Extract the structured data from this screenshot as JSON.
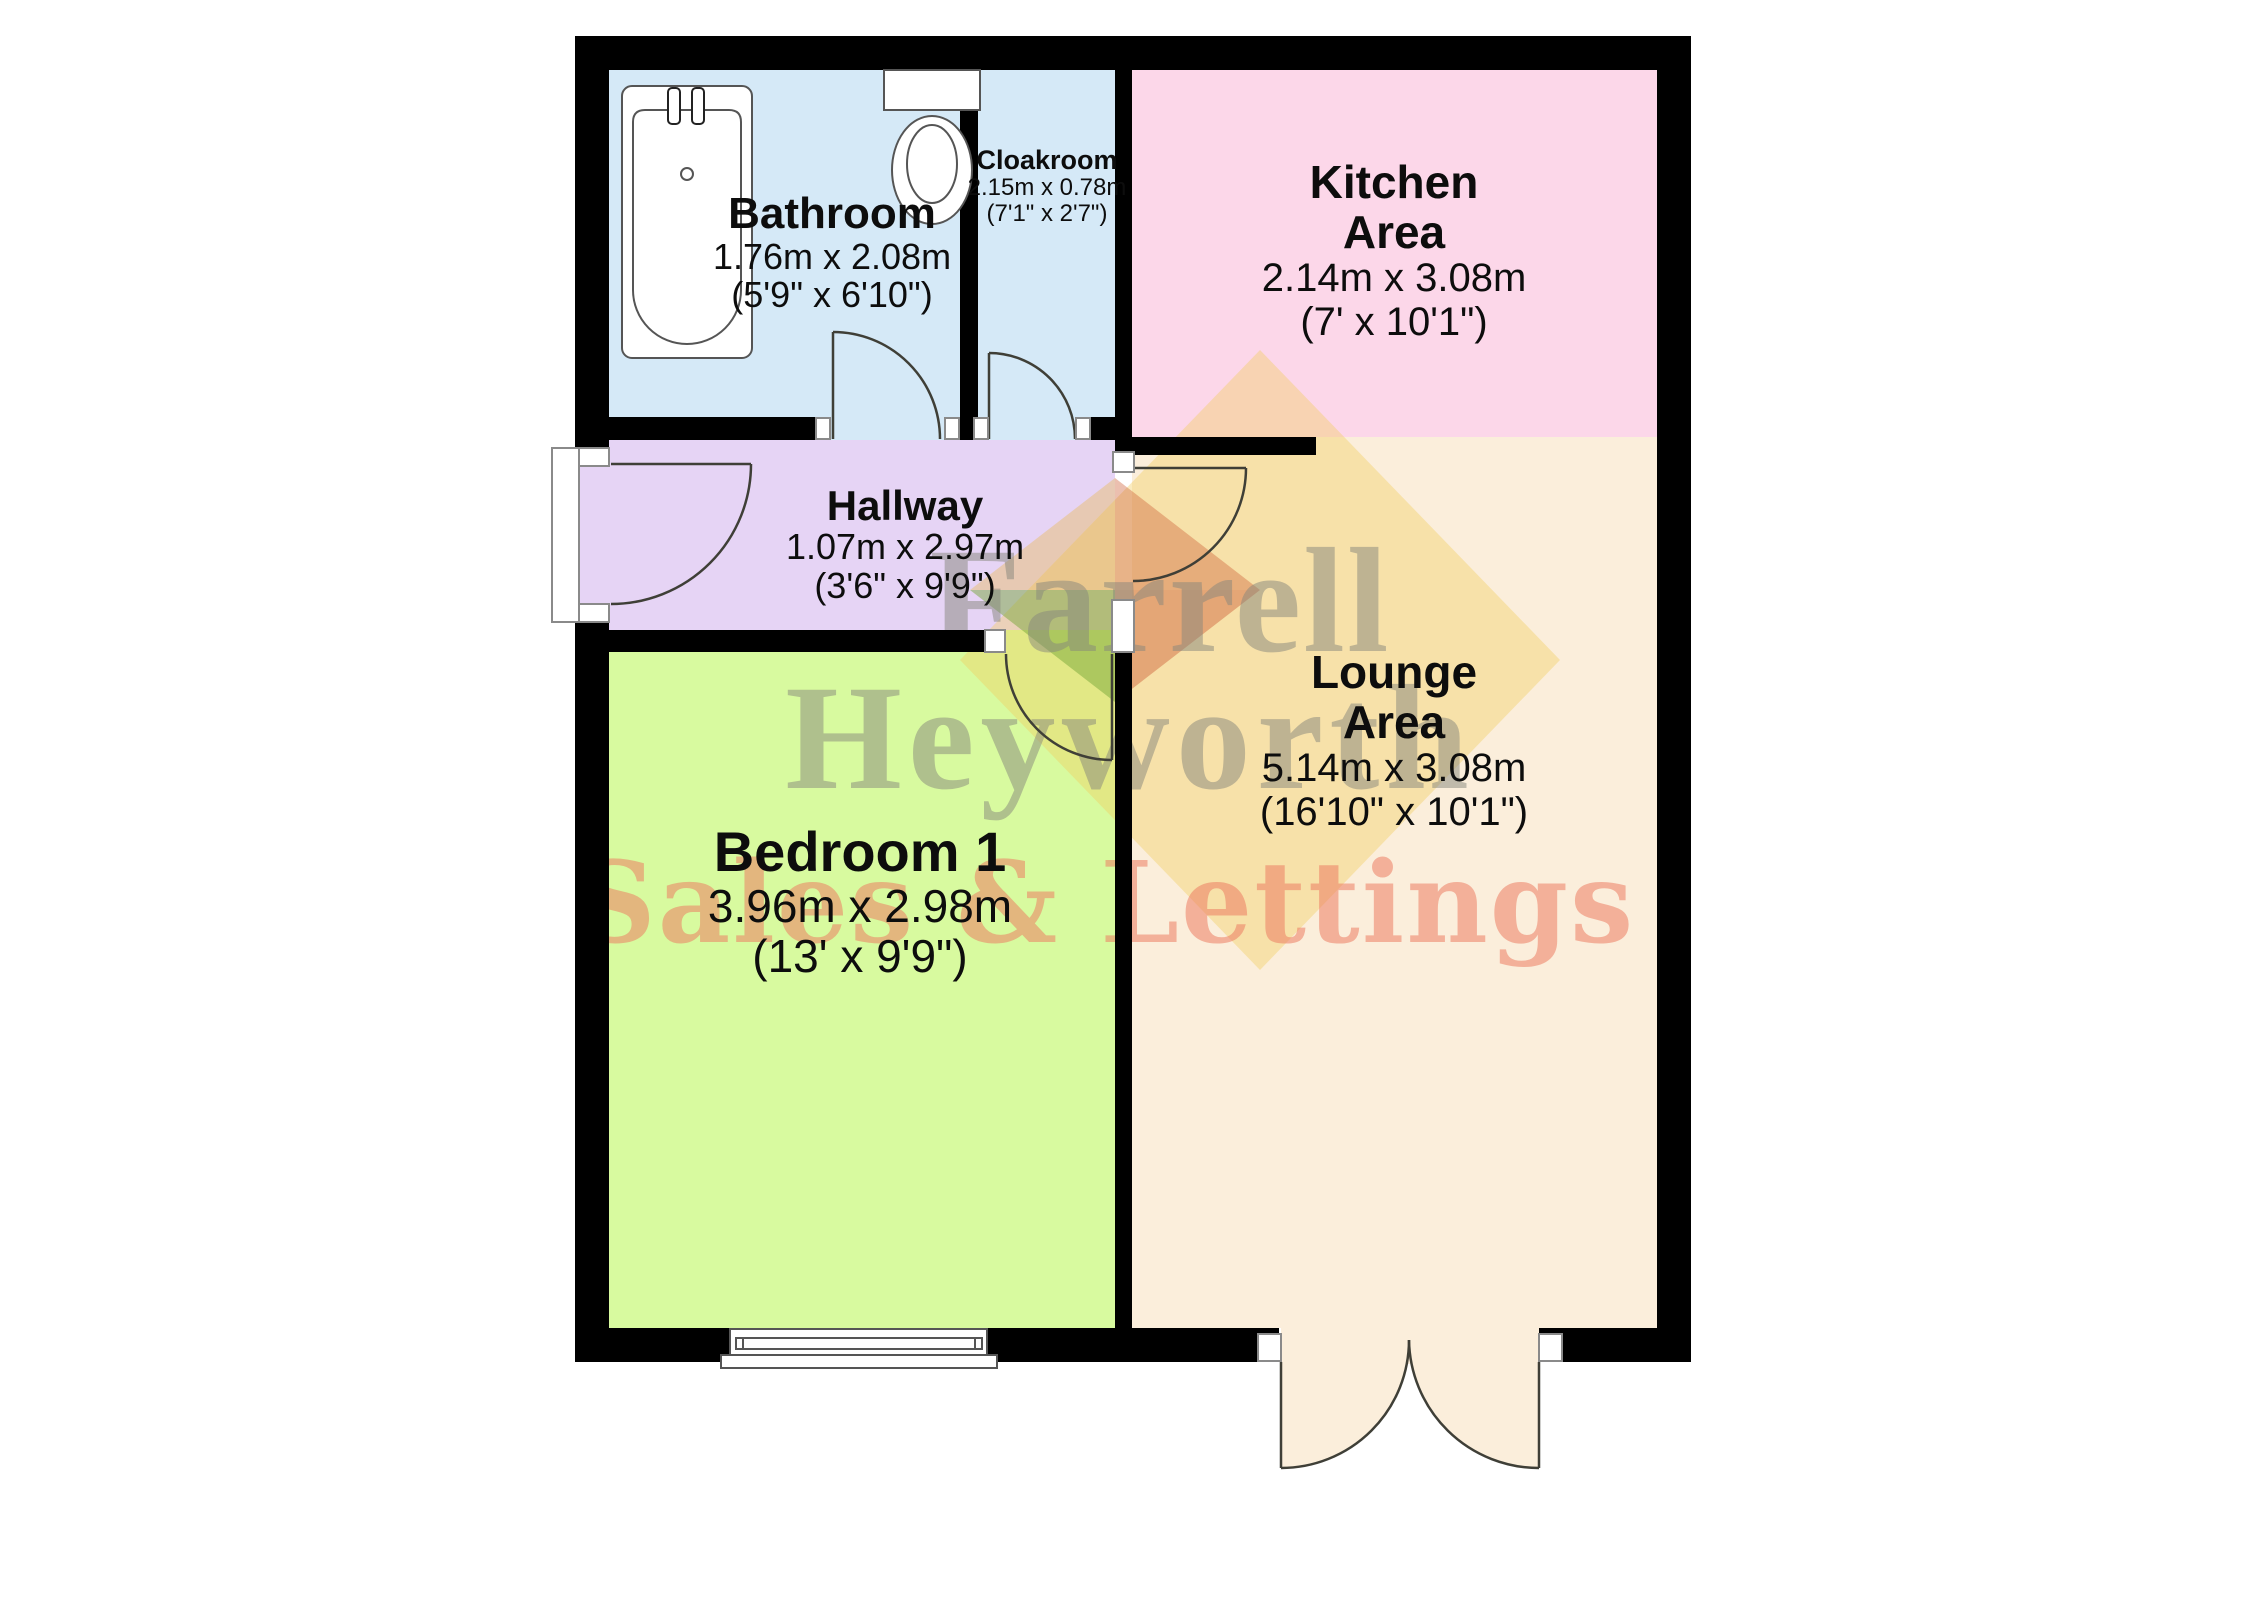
{
  "floorplan": {
    "background_color": "#ffffff",
    "wall_color": "#000000",
    "door_line_color": "#3f3f37",
    "rooms": [
      {
        "id": "bathroom",
        "name": "Bathroom",
        "dim_m": "1.76m x 2.08m",
        "dim_ft": "(5'9\" x 6'10\")",
        "color": "#d5e9f7"
      },
      {
        "id": "cloakroom",
        "name": "Cloakroom",
        "dim_m": "2.15m x 0.78m",
        "dim_ft": "(7'1\" x 2'7\")",
        "color": "#d5e9f7"
      },
      {
        "id": "kitchen",
        "name": "Kitchen Area",
        "name_line1": "Kitchen",
        "name_line2": "Area",
        "dim_m": "2.14m x 3.08m",
        "dim_ft": "(7' x 10'1\")",
        "color": "#fcd7e9"
      },
      {
        "id": "hallway",
        "name": "Hallway",
        "dim_m": "1.07m x 2.97m",
        "dim_ft": "(3'6\" x 9'9\")",
        "color": "#e6d4f5"
      },
      {
        "id": "lounge",
        "name": "Lounge Area",
        "name_line1": "Lounge",
        "name_line2": "Area",
        "dim_m": "5.14m x 3.08m",
        "dim_ft": "(16'10\" x 10'1\")",
        "color": "#fbeedb"
      },
      {
        "id": "bedroom",
        "name": "Bedroom 1",
        "dim_m": "3.96m x 2.98m",
        "dim_ft": "(13' x 9'9\")",
        "color": "#d8fa9f"
      }
    ],
    "watermark": {
      "line1": "Farrell",
      "line2": "Heyworth",
      "line3": "Sales & Lettings",
      "text_color": "rgba(133,133,124,0.5)",
      "accent_color": "rgba(236,126,98,0.55)",
      "diamond_color": "#f3ce5f",
      "logo_green": "#73a537",
      "logo_red": "#cd5f37"
    },
    "fixtures": [
      "bath-tub",
      "toilet",
      "entrance-door",
      "bathroom-door",
      "cloakroom-door",
      "lounge-door",
      "bedroom-door",
      "bedroom-window",
      "french-doors"
    ]
  }
}
